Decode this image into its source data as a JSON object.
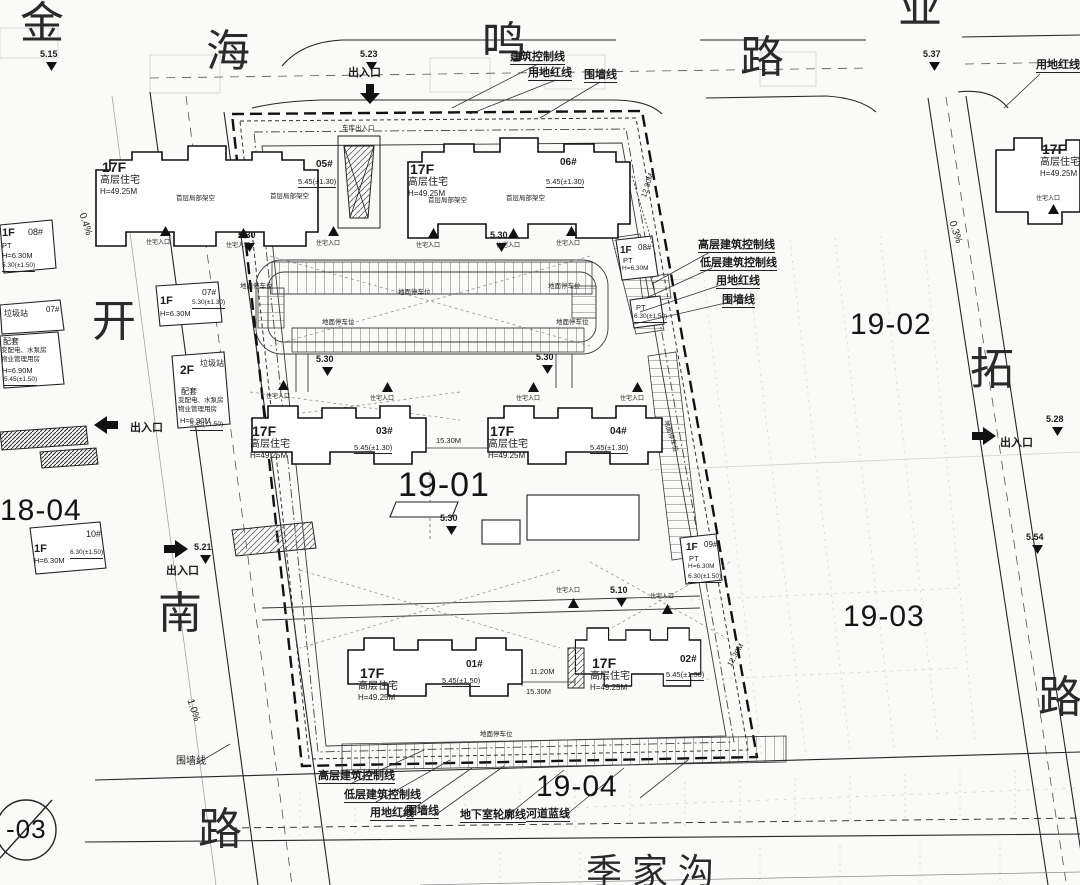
{
  "roads": {
    "chars": [
      "金",
      "海",
      "鸣",
      "路",
      "业",
      "开",
      "南",
      "路",
      "拓",
      "路"
    ],
    "river": "季家沟"
  },
  "parcels": {
    "c": "19-01",
    "e": "19-02",
    "se": "19-03",
    "s": "19-04",
    "w": "18-04",
    "sw": "-03"
  },
  "callouts": {
    "entry": "出入口",
    "bcl": "建筑控制线",
    "redline": "用地红线",
    "wall": "围墙线",
    "hbcl": "高层建筑控制线",
    "lbcl": "低层建筑控制线",
    "basement": "地下室轮廓线",
    "riverline": "河道蓝线"
  },
  "buildings": {
    "floors_hi": "17F",
    "type_hi": "高层住宅",
    "height_hi": "H=49.25M",
    "units": {
      "u01": "01#",
      "u02": "02#",
      "u03": "03#",
      "u04": "04#",
      "u05": "05#",
      "u06": "06#",
      "u07": "07#",
      "u08": "08#",
      "u09": "09#",
      "u10": "10#"
    },
    "elev_130": "5.45(±1.30)",
    "elev_150": "5.45(±1.50)",
    "podium": "首层局部架空",
    "entrance": "住宅入口",
    "garage": "车库出入口",
    "f1": "1F",
    "f2": "2F",
    "pt": "PT",
    "h630": "H=6.30M",
    "h690": "H=6.90M",
    "e630": "6.30(±1.50)",
    "e530_130": "5.30(±1.30)",
    "e530_150": "5.30(±1.50)",
    "trash": "垃圾站",
    "ancillary": "配套",
    "anc1": "变配电、水泵房",
    "anc2": "物业管理用房"
  },
  "parking": {
    "surface": "地面停车位"
  },
  "levels": {
    "v515": "5.15",
    "v521": "5.21",
    "v523": "5.23",
    "v528": "5.28",
    "v530": "5.30",
    "v537": "5.37",
    "v554": "5.54",
    "v510": "5.10"
  },
  "slopes": {
    "s04": "0.4%",
    "s03": "0.3%",
    "s10": "1.0%"
  },
  "dims": {
    "d1230": "12.30M",
    "d1530": "15.30M",
    "d1120": "11.20M"
  }
}
